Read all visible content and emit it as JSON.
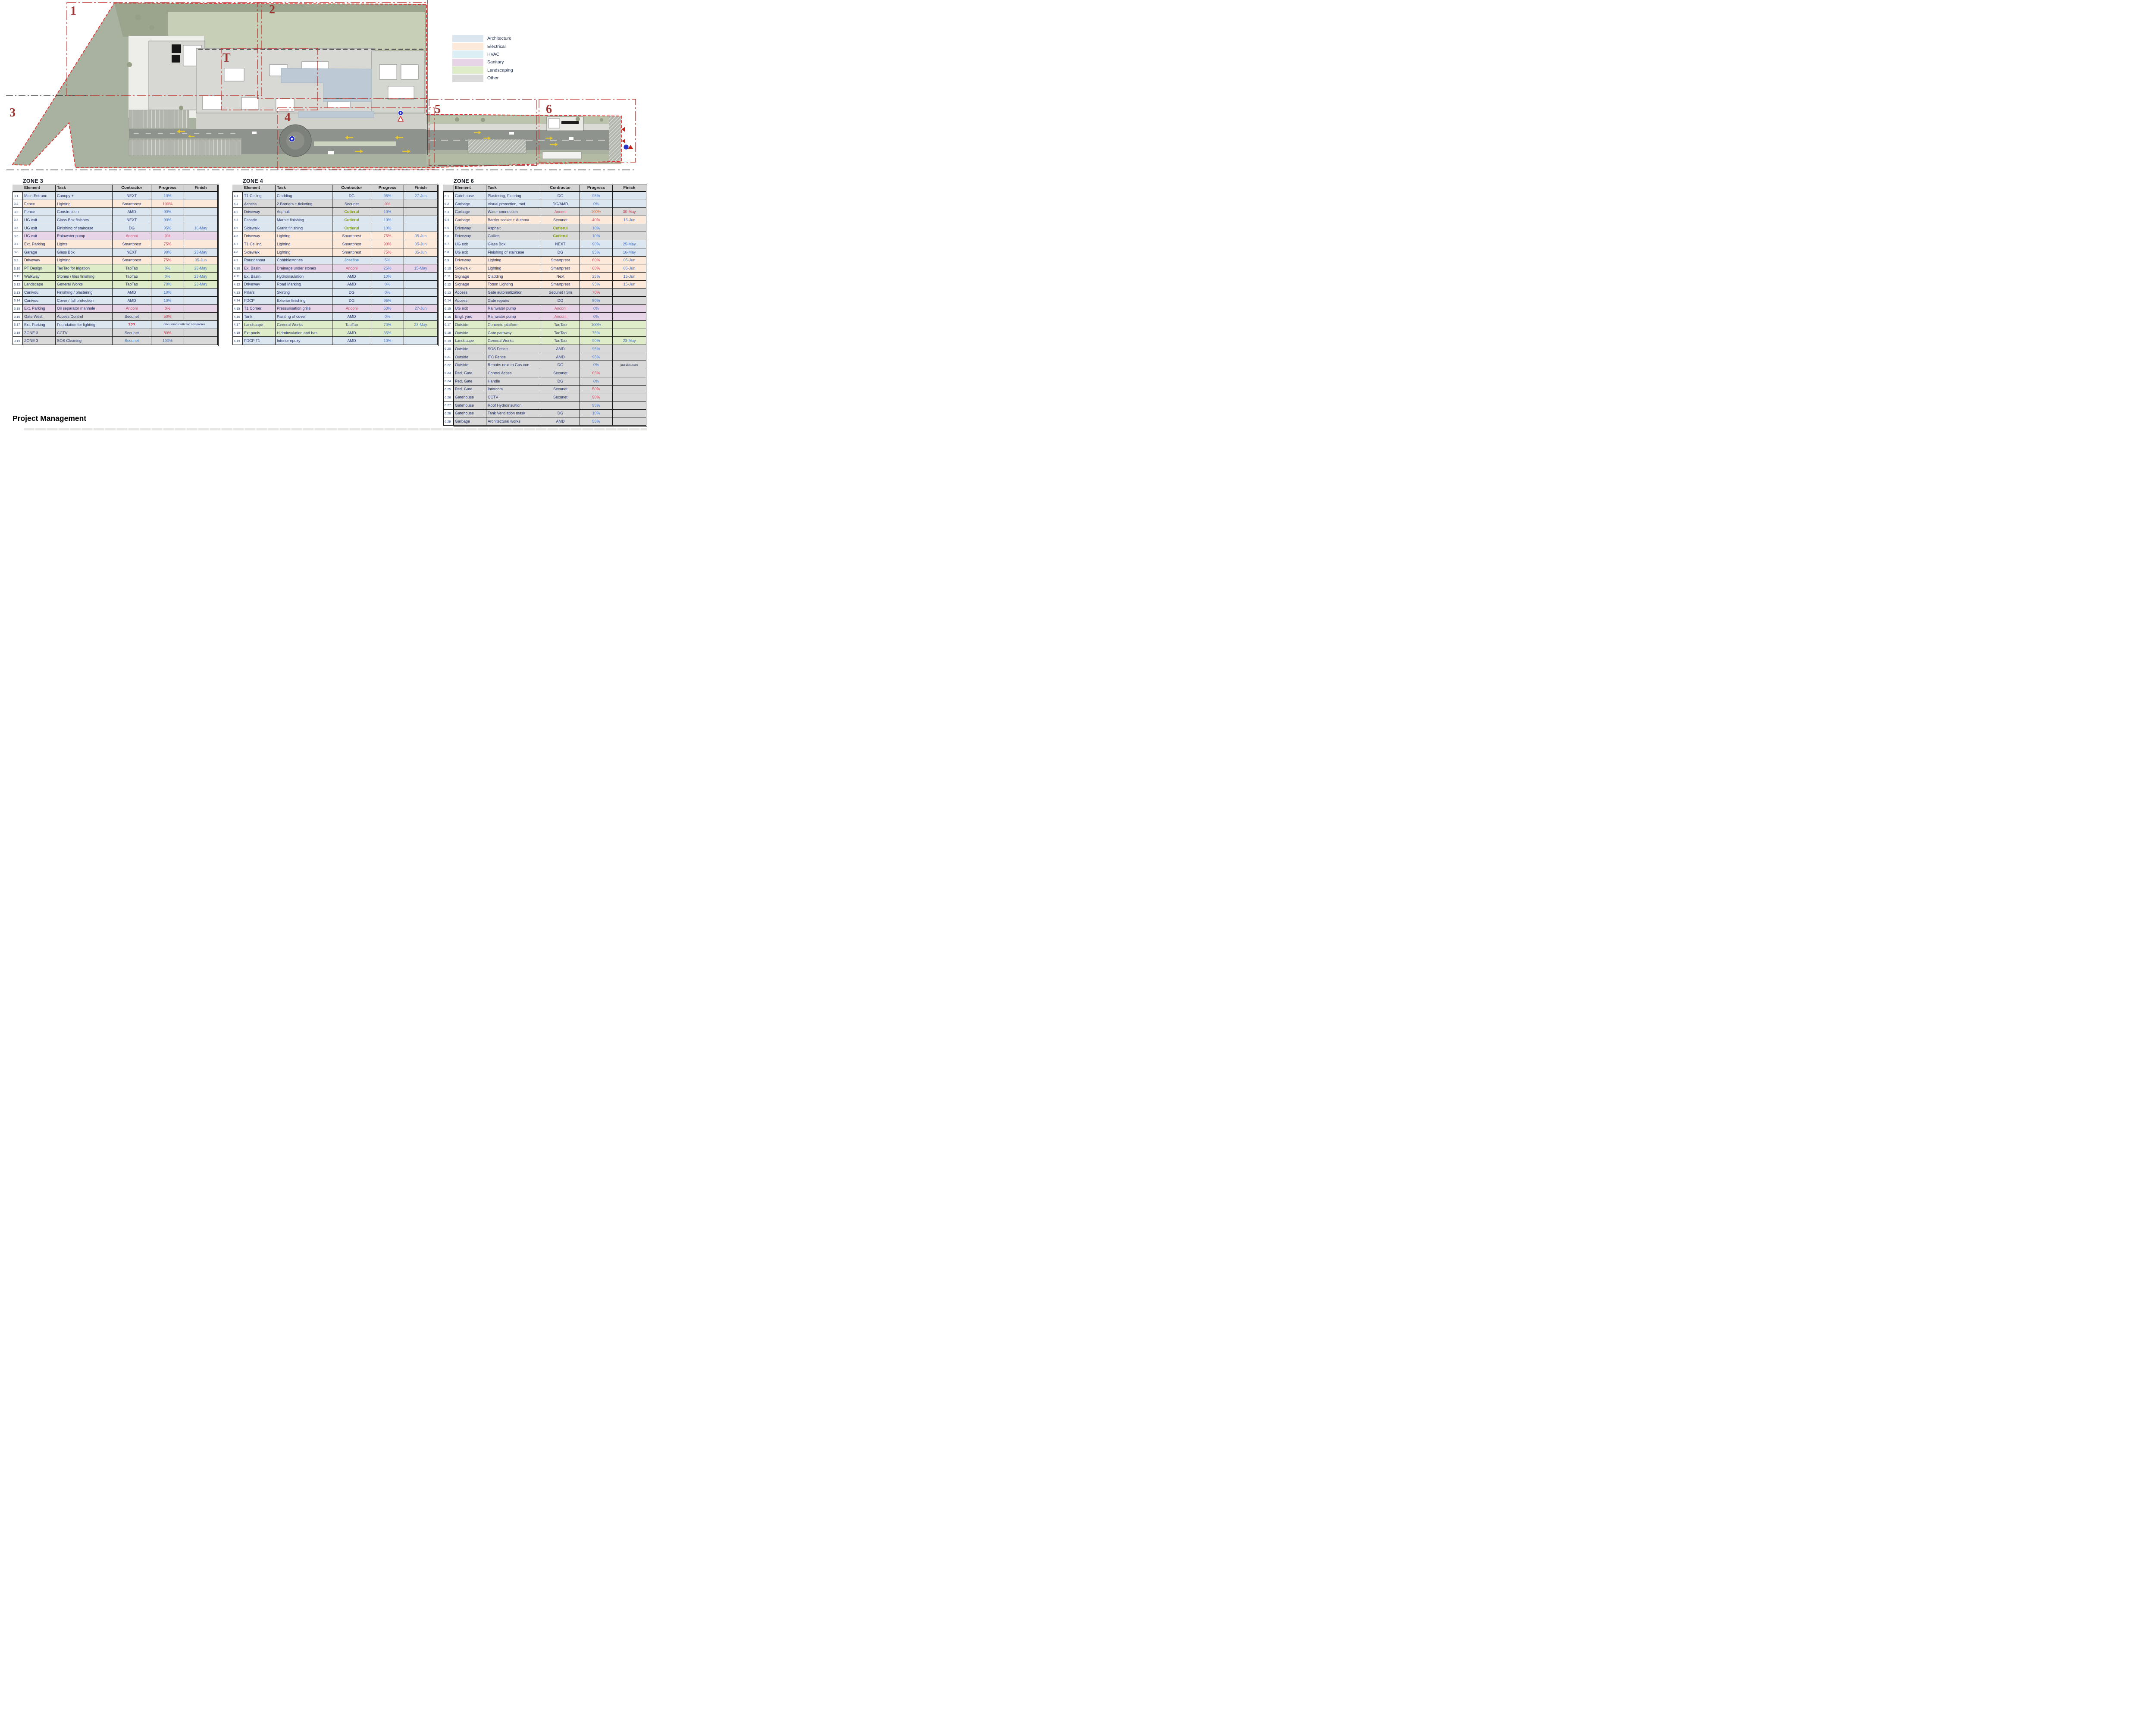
{
  "page": {
    "title": "Project Management"
  },
  "legend": {
    "items": [
      {
        "label": "Architecture",
        "color": "#dce6f1"
      },
      {
        "label": "Electrical",
        "color": "#fde9d9"
      },
      {
        "label": "HVAC",
        "color": "#daeef3"
      },
      {
        "label": "Sanitary",
        "color": "#e7d4e7"
      },
      {
        "label": "Landscaping",
        "color": "#dfecca"
      },
      {
        "label": "Other",
        "color": "#d9d9d9"
      }
    ]
  },
  "plan": {
    "zone_labels": [
      "1",
      "2",
      "3",
      "4",
      "5",
      "6",
      "T"
    ],
    "boundary_color": "#e03131",
    "zone_box_color": "#c03a36"
  },
  "colors": {
    "highlight_yellow": "#ffff2e",
    "progress_blue": "#4472c4",
    "progress_red": "#c23b4e",
    "header_gray": "#d4d4d4"
  },
  "tables": [
    {
      "title": "ZONE 3",
      "headers": [
        "Element",
        "Task",
        "Contractor",
        "Progress",
        "Finish"
      ],
      "rows": [
        {
          "n": "3.1",
          "e": "Main Entranc",
          "t": "Canopy +",
          "c": "NEXT",
          "p": "10%",
          "f": "",
          "cat": "arch"
        },
        {
          "n": "3.2",
          "e": "Fence",
          "t": "Lighting",
          "c": "Smartprest",
          "p": "100%",
          "pc": "red",
          "f": "",
          "cat": "elec"
        },
        {
          "n": "3.3",
          "e": "Fence",
          "t": "Construction",
          "c": "AMD",
          "p": "90%",
          "f": "",
          "cat": "arch"
        },
        {
          "n": "3.4",
          "e": "UG exit",
          "t": "Glass Box finishes",
          "c": "NEXT",
          "p": "90%",
          "f": "",
          "cat": "arch"
        },
        {
          "n": "3.5",
          "e": "UG exit",
          "t": "Finishing of staircase",
          "c": "DG",
          "p": "95%",
          "f": "16-May",
          "cat": "arch"
        },
        {
          "n": "3.6",
          "e": "UG exit",
          "t": "Rainwater pump",
          "c": "Anconi",
          "cc": "anc",
          "p": "0%",
          "pc": "red",
          "f": "",
          "cat": "san"
        },
        {
          "n": "3.7",
          "e": "Ext. Parking",
          "t": "Lights",
          "c": "Smartprest",
          "p": "75%",
          "pc": "red",
          "f": "",
          "cat": "elec"
        },
        {
          "n": "3.8",
          "e": "Garage",
          "t": "Glass Box",
          "c": "NEXT",
          "p": "90%",
          "f": "23-May",
          "cat": "arch"
        },
        {
          "n": "3.9",
          "e": "Driveway",
          "t": "Lighting",
          "c": "Smartprest",
          "p": "75%",
          "pc": "red",
          "f": "05-Jun",
          "cat": "elec"
        },
        {
          "n": "3.10",
          "e": "PT Design",
          "t": "TaoTao for irigation",
          "c": "TaoTao",
          "p": "0%",
          "f": "23-May",
          "cat": "land"
        },
        {
          "n": "3.11",
          "e": "Walkway",
          "t": "Stones / tiles finishing",
          "c": "TaoTao",
          "p": "0%",
          "f": "23-May",
          "cat": "land"
        },
        {
          "n": "3.12",
          "e": "Landscape",
          "t": "General Works",
          "c": "TaoTao",
          "p": "70%",
          "f": "23-May",
          "cat": "land"
        },
        {
          "n": "3.13",
          "e": "Canivou",
          "t": "Finishing / plastering",
          "c": "AMD",
          "p": "10%",
          "f": "",
          "cat": "arch"
        },
        {
          "n": "3.14",
          "e": "Canivou",
          "t": "Cover / fall protection",
          "c": "AMD",
          "p": "10%",
          "f": "",
          "cat": "arch"
        },
        {
          "n": "3.15",
          "e": "Ext. Parking",
          "t": "Oil separator manhole",
          "c": "Anconi",
          "cc": "anc",
          "p": "0%",
          "pc": "red",
          "f": "",
          "cat": "san"
        },
        {
          "n": "3.16",
          "e": "Gate West",
          "t": "Access Control",
          "c": "Secunet",
          "p": "50%",
          "pc": "red",
          "f": "",
          "cat": "other"
        },
        {
          "n": "3.17",
          "e": "Ext. Parking",
          "t": "Foundation for lighting",
          "c": "???",
          "cy": true,
          "cc": "redb",
          "note": "discussions with two companies",
          "cat": "arch"
        },
        {
          "n": "3.18",
          "e": "ZONE 3",
          "t": "CCTV",
          "c": "Secunet",
          "p": "80%",
          "pc": "red",
          "f": "",
          "cat": "other"
        },
        {
          "n": "3.19",
          "e": "ZONE 3",
          "t": "SOS Cleaning",
          "c": "Secunet",
          "cc": "bluec",
          "p": "100%",
          "f": "",
          "cat": "other"
        }
      ]
    },
    {
      "title": "ZONE 4",
      "headers": [
        "Element",
        "Task",
        "Contractor",
        "Progress",
        "Finish"
      ],
      "rows": [
        {
          "n": "4.1",
          "e": "T1 Ceiling",
          "t": "Cladding",
          "c": "DG",
          "p": "95%",
          "f": "27-Jun",
          "cat": "arch"
        },
        {
          "n": "4.2",
          "e": "Access",
          "t": "2 Barriers + ticketing",
          "c": "Secunet",
          "p": "0%",
          "pc": "red",
          "f": "",
          "cat": "other"
        },
        {
          "n": "4.3",
          "e": "Driveway",
          "t": "Asphalt",
          "c": "Cutierul",
          "cy": true,
          "cc": "greenx",
          "p": "10%",
          "f": "",
          "cat": "other"
        },
        {
          "n": "4.4",
          "e": "Facade",
          "t": "Marble finishing",
          "c": "Cutierul",
          "cy": true,
          "cc": "greenx",
          "p": "10%",
          "f": "",
          "cat": "arch"
        },
        {
          "n": "4.5",
          "e": "Sidewalk",
          "t": "Granit finishing",
          "c": "Cutierul",
          "cy": true,
          "cc": "greenx",
          "p": "10%",
          "f": "",
          "cat": "arch"
        },
        {
          "n": "4.6",
          "e": "Driveway",
          "t": "Lighting",
          "c": "Smartprest",
          "p": "75%",
          "pc": "red",
          "f": "05-Jun",
          "cat": "elec"
        },
        {
          "n": "4.7",
          "e": "T1 Ceiling",
          "t": "Lighting",
          "c": "Smartprest",
          "p": "90%",
          "pc": "red",
          "f": "05-Jun",
          "cat": "elec"
        },
        {
          "n": "4.8",
          "e": "Sidewalk",
          "t": "Lighting",
          "c": "Smartprest",
          "p": "75%",
          "pc": "red",
          "f": "05-Jun",
          "cat": "elec"
        },
        {
          "n": "4.9",
          "e": "Roundabout",
          "t": "Cobbblestones",
          "c": "Josefine",
          "cy": true,
          "cc": "bluec",
          "p": "5%",
          "f": "",
          "cat": "arch"
        },
        {
          "n": "4.10",
          "e": "Ex. Basin",
          "t": "Drainage under stones",
          "c": "Anconi",
          "cc": "anc",
          "p": "25%",
          "f": "15-May",
          "cat": "san"
        },
        {
          "n": "4.11",
          "e": "Ex. Basin",
          "t": "Hydroinsulation",
          "c": "AMD",
          "p": "10%",
          "f": "",
          "cat": "arch"
        },
        {
          "n": "4.12",
          "e": "Driveway",
          "t": "Road Marking",
          "c": "AMD",
          "p": "0%",
          "f": "",
          "cat": "arch"
        },
        {
          "n": "4.13",
          "e": "Pillars",
          "t": "Skirting",
          "c": "DG",
          "p": "0%",
          "f": "",
          "cat": "arch"
        },
        {
          "n": "4.14",
          "e": "FDCP",
          "t": "Exterior finishing",
          "c": "DG",
          "p": "95%",
          "f": "",
          "cat": "arch"
        },
        {
          "n": "4.15",
          "e": "T1 Corner",
          "t": "Pressurisation grille",
          "c": "Anconi",
          "cc": "anc",
          "p": "50%",
          "f": "27-Jun",
          "cat": "san"
        },
        {
          "n": "4.16",
          "e": "Tank",
          "t": "Painting of cover",
          "c": "AMD",
          "p": "0%",
          "f": "",
          "cat": "arch"
        },
        {
          "n": "4.17",
          "e": "Landscape",
          "t": "General Works",
          "c": "TaoTao",
          "p": "70%",
          "f": "23-May",
          "cat": "land"
        },
        {
          "n": "4.18",
          "e": "Ext pools",
          "t": "Hidroinsulation and bas",
          "c": "AMD",
          "p": "35%",
          "f": "",
          "cat": "land"
        },
        {
          "n": "4.19",
          "e": "FDCP T1",
          "t": "Interior epoxy",
          "c": "AMD",
          "p": "10%",
          "f": "",
          "cat": "arch"
        }
      ]
    },
    {
      "title": "ZONE 6",
      "headers": [
        "Element",
        "Task",
        "Contractor",
        "Progress",
        "Finish"
      ],
      "rows": [
        {
          "n": "6.1",
          "e": "Gatehouse",
          "t": "Plastering, Flooring",
          "c": "DG",
          "p": "95%",
          "f": "",
          "cat": "arch"
        },
        {
          "n": "6.2",
          "e": "Garbage",
          "t": "Visual protection, roof",
          "c": "DG/AMD",
          "p": "0%",
          "f": "",
          "cat": "arch"
        },
        {
          "n": "6.3",
          "e": "Garbage",
          "t": "Water connection",
          "c": "Anconi",
          "cc": "anc",
          "p": "100%",
          "pc": "orange",
          "f": "30-May",
          "fc": "red",
          "cat": "other"
        },
        {
          "n": "6.4",
          "e": "Garbage",
          "t": "Barrier socket + Automa",
          "c": "Secunet",
          "p": "40%",
          "pc": "red",
          "f": "15-Jun",
          "cat": "elec"
        },
        {
          "n": "6.5",
          "e": "Driveway",
          "t": "Asphalt",
          "c": "Cutierul",
          "cy": true,
          "cc": "greenx",
          "p": "10%",
          "f": "",
          "cat": "other"
        },
        {
          "n": "6.6",
          "e": "Driveway",
          "t": "Gullies",
          "c": "Cutierul",
          "cy": true,
          "cc": "greenx",
          "p": "10%",
          "f": "",
          "cat": "other"
        },
        {
          "n": "6.7",
          "e": "UG exit",
          "t": "Glass Box",
          "c": "NEXT",
          "p": "90%",
          "f": "25-May",
          "cat": "arch"
        },
        {
          "n": "6.8",
          "e": "UG exit",
          "t": "Finishing of staircase",
          "c": "DG",
          "p": "95%",
          "f": "16-May",
          "cat": "arch"
        },
        {
          "n": "6.9",
          "e": "Driveway",
          "t": "Lighting",
          "c": "Smartprest",
          "p": "60%",
          "pc": "red",
          "f": "05-Jun",
          "cat": "elec"
        },
        {
          "n": "6.10",
          "e": "Sidewalk",
          "t": "Lighting",
          "c": "Smartprest",
          "p": "60%",
          "pc": "red",
          "f": "05-Jun",
          "cat": "elec"
        },
        {
          "n": "6.11",
          "e": "Signage",
          "t": "Cladding",
          "c": "Next",
          "p": "25%",
          "f": "15-Jun",
          "cat": "elec"
        },
        {
          "n": "6.12",
          "e": "Signage",
          "t": "Totem Lighting",
          "c": "Smartprest",
          "p": "95%",
          "f": "15-Jun",
          "cat": "elec"
        },
        {
          "n": "6.13",
          "e": "Access",
          "t": "Gate automatization",
          "c": "Secunet / Sm",
          "p": "70%",
          "pc": "red",
          "f": "",
          "cat": "other"
        },
        {
          "n": "6.14",
          "e": "Access",
          "t": "Gate repairs",
          "c": "DG",
          "p": "50%",
          "f": "",
          "cat": "other"
        },
        {
          "n": "6.15",
          "e": "UG exit",
          "t": "Rainwater pump",
          "c": "Anconi",
          "cc": "anc",
          "p": "0%",
          "f": "",
          "cat": "san"
        },
        {
          "n": "6.16",
          "e": "Engl. yard",
          "t": "Rainwater pump",
          "c": "Anconi",
          "cc": "anc",
          "p": "0%",
          "f": "",
          "cat": "san"
        },
        {
          "n": "6.17",
          "e": "Outside",
          "t": "Concrete platform",
          "c": "TaoTao",
          "p": "100%",
          "f": "",
          "cat": "land"
        },
        {
          "n": "6.18",
          "e": "Outside",
          "t": "Gate pathway",
          "c": "TaoTao",
          "p": "75%",
          "f": "",
          "cat": "land"
        },
        {
          "n": "6.19",
          "e": "Landscape",
          "t": "General Works",
          "c": "TaoTao",
          "p": "90%",
          "f": "23-May",
          "cat": "land"
        },
        {
          "n": "6.20",
          "e": "Outside",
          "t": "SOS Fence",
          "c": "AMD",
          "p": "95%",
          "f": "",
          "cat": "other"
        },
        {
          "n": "6.21",
          "e": "Outside",
          "t": "ITC Fence",
          "c": "AMD",
          "p": "95%",
          "f": "",
          "cat": "other"
        },
        {
          "n": "6.22",
          "e": "Outside",
          "t": "Repairs next to Gas con",
          "c": "DG",
          "p": "0%",
          "f": "just discussed",
          "fs": true,
          "cat": "other"
        },
        {
          "n": "6.23",
          "e": "Ped. Gate",
          "t": "Control Acces",
          "c": "Secunet",
          "p": "65%",
          "pc": "red",
          "f": "",
          "cat": "other"
        },
        {
          "n": "6.24",
          "e": "Ped. Gate",
          "t": "Handle",
          "c": "DG",
          "cy": true,
          "p": "0%",
          "f": "",
          "cat": "other"
        },
        {
          "n": "6.25",
          "e": "Ped. Gate",
          "t": "Intercom",
          "c": "Secunet",
          "p": "50%",
          "pc": "red",
          "f": "",
          "cat": "other"
        },
        {
          "n": "6.26",
          "e": "Gatehouse",
          "t": "CCTV",
          "c": "Secunet",
          "p": "90%",
          "pc": "red",
          "f": "",
          "cat": "other"
        },
        {
          "n": "6.27",
          "e": "Gatehouse",
          "t": "Roof Hydroinsultion",
          "c": "",
          "p": "95%",
          "f": "",
          "cat": "other"
        },
        {
          "n": "6.28",
          "e": "Gatehouse",
          "t": "Tank Ventilation mask",
          "c": "DG",
          "p": "10%",
          "f": "",
          "cat": "other"
        },
        {
          "n": "6.29",
          "e": "Garbage",
          "t": "Architectural works",
          "c": "AMD",
          "p": "55%",
          "f": "",
          "cat": "other"
        }
      ]
    }
  ]
}
